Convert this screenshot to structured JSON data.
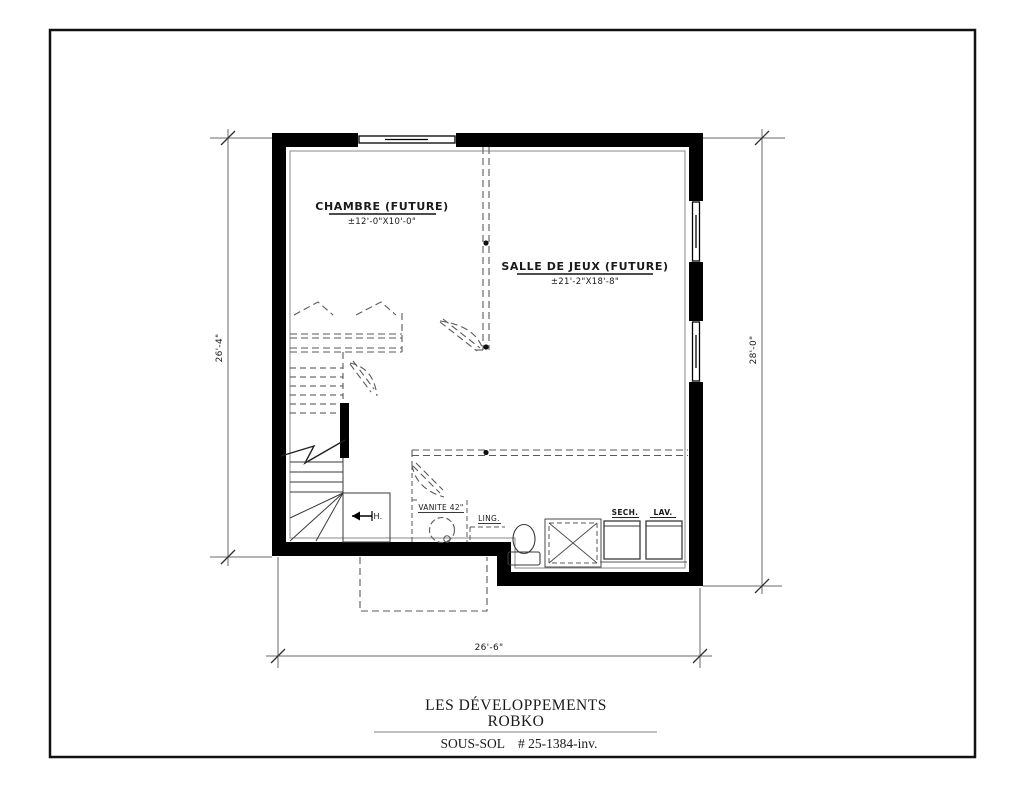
{
  "drawing": {
    "rooms": [
      {
        "name": "CHAMBRE (FUTURE)",
        "size": "±12'-0\"X10'-0\""
      },
      {
        "name": "SALLE DE JEUX (FUTURE)",
        "size": "±21'-2\"X18'-8\""
      }
    ],
    "fixtures": {
      "vanity": "VANITE 42\"",
      "linen": "LING.",
      "dryer": "SECH.",
      "washer": "LAV.",
      "stair_direction": "H."
    },
    "dimensions": {
      "left": "26'-4\"",
      "right": "28'-0\"",
      "bottom": "26'-6\""
    }
  },
  "title_block": {
    "company_line1": "LES DÉVELOPPEMENTS",
    "company_line2": "ROBKO",
    "sheet_name": "SOUS-SOL",
    "project_number": "# 25-1384-inv."
  },
  "colors": {
    "wall": "#000000",
    "thin_line": "#3a3a3a",
    "dashed_line": "#5a5a5a",
    "dimension_line": "#6a6a6a"
  }
}
